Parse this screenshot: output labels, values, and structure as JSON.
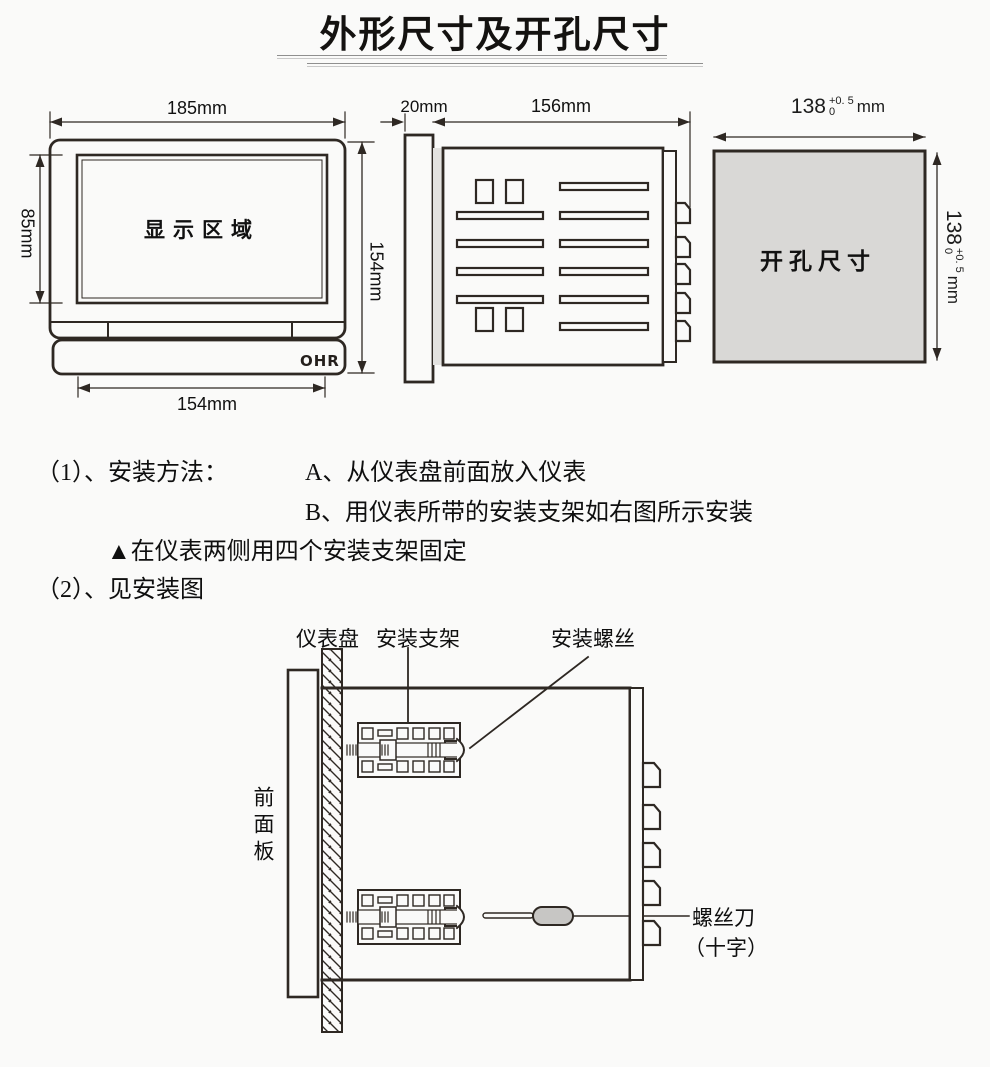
{
  "title": "外形尺寸及开孔尺寸",
  "outline_figure": {
    "front_view": {
      "width_dim": "185mm",
      "display_height_dim": "85mm",
      "height_dim": "154mm",
      "bottom_width_dim": "154mm",
      "display_label": "显示区域",
      "brand_logo": "OHR"
    },
    "side_view": {
      "bezel_depth_dim": "20mm",
      "body_depth_dim": "156mm"
    },
    "cutout_view": {
      "label": "开孔尺寸",
      "width_value": "138",
      "width_tol_upper": "+0. 5",
      "width_tol_lower": "0",
      "width_unit": "mm",
      "height_value": "138",
      "height_tol_upper": "+0. 5",
      "height_tol_lower": "0",
      "height_unit": "mm"
    }
  },
  "instructions": {
    "item1_label": "（1）、安装方法：",
    "item1_a": "A、从仪表盘前面放入仪表",
    "item1_b": "B、用仪表所带的安装支架如右图所示安装",
    "note": "▲在仪表两侧用四个安装支架固定",
    "item2": "（2）、见安装图"
  },
  "install_figure": {
    "panel_label": "仪表盘",
    "bracket_label": "安装支架",
    "screw_label": "安装螺丝",
    "front_panel_label": "前面板",
    "screwdriver_label": "螺丝刀",
    "screwdriver_label_sub": "（十字）"
  },
  "colors": {
    "line": "#2e2823",
    "cutout_fill": "#d9d8d6",
    "handle_fill": "#c7c6c4",
    "background": "#fafaf9"
  }
}
